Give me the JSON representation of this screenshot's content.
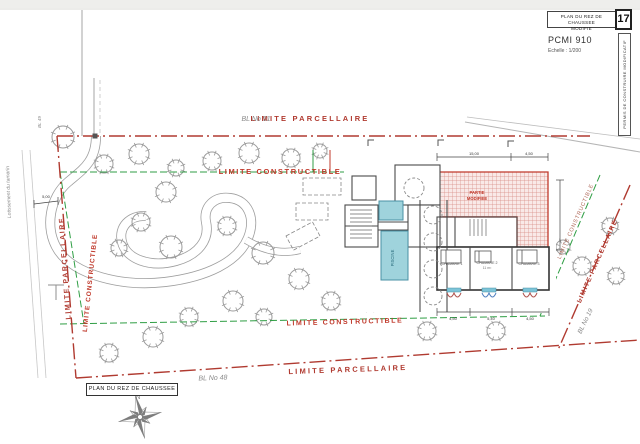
{
  "sheet": {
    "title_box_line1": "PLAN DU REZ DE CHAUSSEE",
    "title_box_line2": "MODIFIE",
    "sheet_number": "17",
    "doc_ref": "PCMI 910",
    "scale_label": "Echelle : 1/200",
    "side_strip_label": "PERMIS DE CONSTRUIRE MODIFICATIF",
    "bottom_plan_label": "PLAN DU REZ DE CHAUSSEE",
    "north_label": "N"
  },
  "boundaries": {
    "parcel_label": "LIMITE PARCELLAIRE",
    "constructible_label": "LIMITE CONSTRUCTIBLE",
    "parcel_color": "#b03a30",
    "constructible_color": "#2f9e44"
  },
  "neighbors": {
    "north": "BL No 51",
    "south": "BL No 48",
    "east": "BL No 19",
    "west_road": "BL 49",
    "street": "Lotissement du tamarin"
  },
  "building": {
    "rooms": [
      {
        "name": "CHAMBRE 1"
      },
      {
        "name": "CHAMBRE 2",
        "area": "11 m²"
      },
      {
        "name": "CHAMBRE 3"
      }
    ],
    "pool_label": "PISCINE",
    "modified_zone_label_line1": "PARTIE",
    "modified_zone_label_line2": "MODIFIEE"
  },
  "dimensions": {
    "top": [
      "15,00",
      "4,50"
    ],
    "bottom": [
      "4,50",
      "5,40",
      "4,50"
    ],
    "access": "5,00"
  },
  "site": {
    "trees": [
      [
        63,
        137,
        11
      ],
      [
        104,
        164,
        9
      ],
      [
        139,
        154,
        10
      ],
      [
        176,
        168,
        8
      ],
      [
        212,
        161,
        9
      ],
      [
        249,
        153,
        10
      ],
      [
        291,
        158,
        9
      ],
      [
        320,
        151,
        7
      ],
      [
        166,
        192,
        10
      ],
      [
        141,
        222,
        9
      ],
      [
        119,
        248,
        8
      ],
      [
        171,
        247,
        11
      ],
      [
        227,
        226,
        9
      ],
      [
        263,
        253,
        11
      ],
      [
        299,
        279,
        10
      ],
      [
        331,
        301,
        9
      ],
      [
        233,
        301,
        10
      ],
      [
        189,
        317,
        9
      ],
      [
        153,
        337,
        10
      ],
      [
        109,
        353,
        9
      ],
      [
        264,
        317,
        8
      ],
      [
        370,
        303,
        8
      ],
      [
        427,
        331,
        9
      ],
      [
        496,
        331,
        9
      ],
      [
        582,
        266,
        9
      ],
      [
        610,
        226,
        8
      ],
      [
        616,
        276,
        8
      ],
      [
        563,
        247,
        7
      ]
    ]
  },
  "colors": {
    "pool": "#9fd3dc",
    "hatch_red": "#cc4b4b",
    "walls": "#4a4a4a",
    "tree": "#9b9b9b"
  }
}
